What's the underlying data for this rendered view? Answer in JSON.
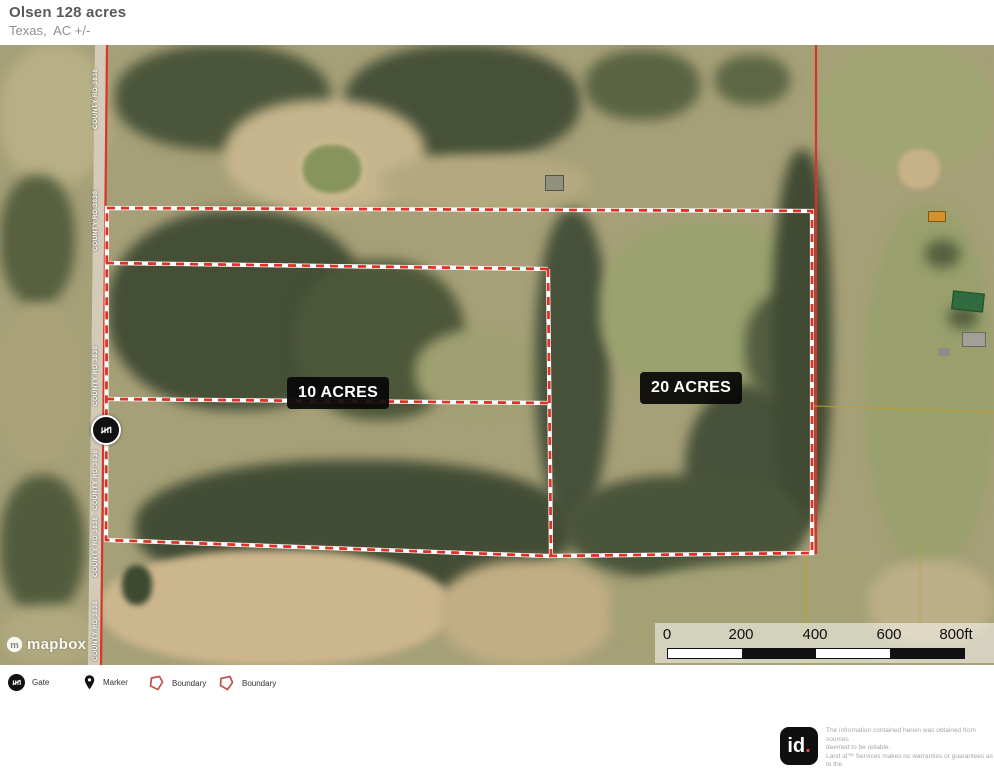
{
  "header": {
    "title": "Olsen 128 acres",
    "subtitle": "Texas,  AC +/-"
  },
  "map": {
    "road_label": "COUNTY RD 3838",
    "parcel_labels": {
      "west": "10 ACRES",
      "east": "20 ACRES"
    },
    "attribution": "mapbox"
  },
  "scale_bar": {
    "ticks": [
      "0",
      "200",
      "400",
      "600",
      "800ft"
    ]
  },
  "legend": {
    "items": [
      {
        "icon": "gate-icon",
        "label": "Gate"
      },
      {
        "icon": "marker-icon",
        "label": "Marker"
      },
      {
        "icon": "boundary-icon",
        "label": "Boundary"
      },
      {
        "icon": "boundary-icon",
        "label": "Boundary"
      }
    ]
  },
  "disclaimer": {
    "logo_text": "id",
    "logo_dot": ".",
    "lines": [
      "The information contained herein was obtained from sources",
      "deemed to be reliable.",
      " Land id™ Services makes no warranties or guarantees as to the",
      "completeness or accuracy thereof"
    ]
  },
  "colors": {
    "boundary_red": "#e03127",
    "road_red": "#db3327",
    "marker_black": "#111111",
    "logo_dot_red": "#e04338"
  }
}
